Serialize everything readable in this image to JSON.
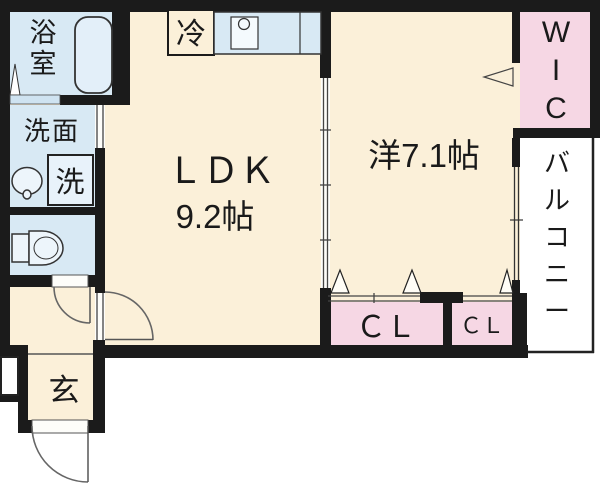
{
  "plan_title": "1LDK floor plan",
  "rooms": {
    "bathroom": {
      "label": "浴室"
    },
    "washroom": {
      "label": "洗面"
    },
    "washer": {
      "label": "洗"
    },
    "toilet": {
      "label": ""
    },
    "refrigerator": {
      "label": "冷"
    },
    "ldk": {
      "label": "ＬＤＫ",
      "size": "9.2帖"
    },
    "western_room": {
      "label": "洋7.1帖"
    },
    "wic": {
      "label": "WIC"
    },
    "balcony": {
      "label": "バルコニー"
    },
    "closet_main": {
      "label": "ＣＬ"
    },
    "closet_sub": {
      "label": "ＣＬ"
    },
    "entrance": {
      "label": "玄"
    }
  },
  "colors": {
    "wall": "#1b1b1b",
    "floor": "#fbf0d9",
    "wet_area": "#d8e9f4",
    "closet": "#f6d7e4",
    "balcony": "#ffffff",
    "fixture_fill": "#e8f2fa"
  }
}
